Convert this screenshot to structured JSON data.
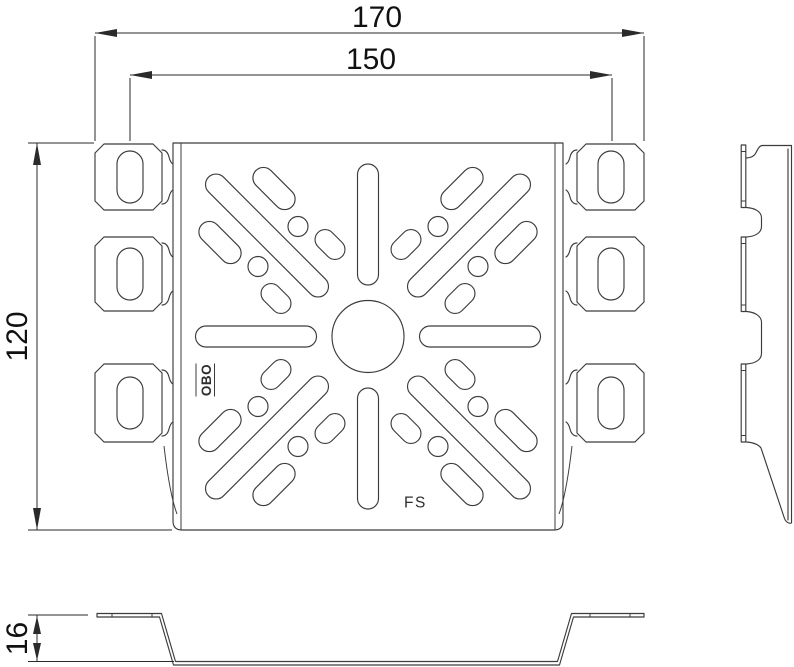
{
  "drawing": {
    "type": "technical-drawing",
    "views": [
      "front",
      "side",
      "bottom"
    ],
    "dimensions": {
      "overall_width": "170",
      "slot_spacing": "150",
      "height": "120",
      "profile_height": "16"
    },
    "markings": {
      "brand": "OBO",
      "product": "FS"
    },
    "colors": {
      "line": "#3c3c3c",
      "dim": "#2a2a2a",
      "text": "#111111",
      "background": "#ffffff"
    }
  }
}
